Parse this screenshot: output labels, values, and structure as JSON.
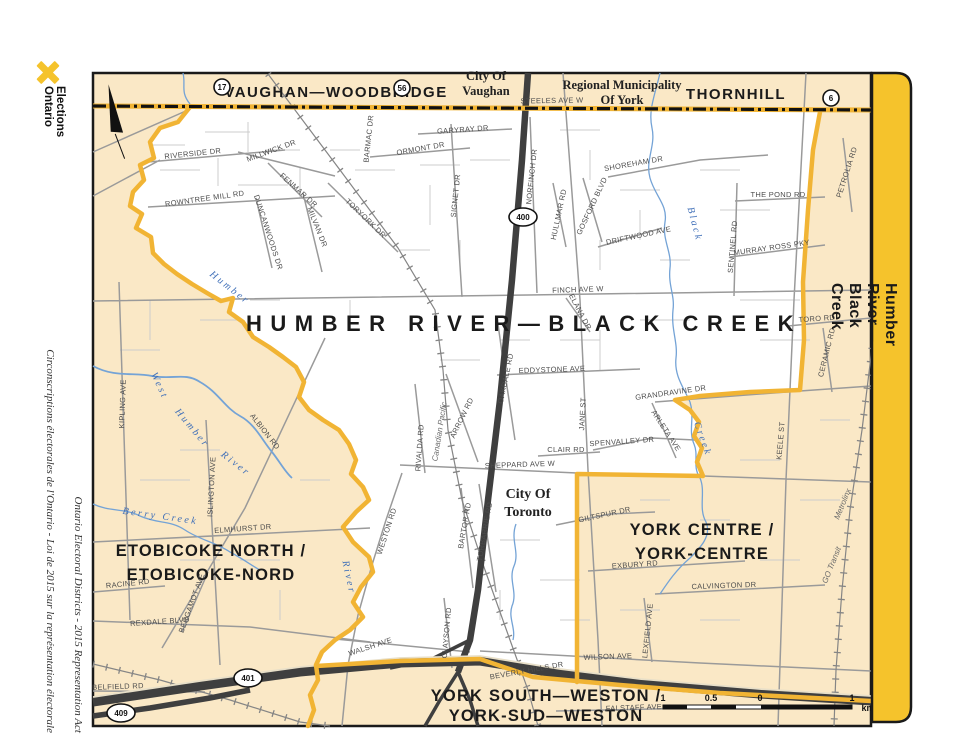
{
  "branding": {
    "logo": "Elections\nOntario"
  },
  "side_captions": {
    "english": "Ontario Electoral Districts - 2015 Representation Act",
    "french": "Circonscriptions électorales de l'Ontario - Loi de 2015 sur la représentation électorale"
  },
  "edge_band": {
    "label": "Humber River—Black Creek"
  },
  "colors": {
    "boundary": "#F1B434",
    "band": "#F5C32C",
    "cream": "#FAE8C6",
    "water": "#74A3D6",
    "highway": "#3f3f3f"
  },
  "map": {
    "title": "HUMBER RIVER—BLACK CREEK",
    "shields": [
      {
        "n": "17",
        "x": 222,
        "y": 87,
        "rx": 8,
        "ry": 8
      },
      {
        "n": "56",
        "x": 402,
        "y": 88,
        "rx": 8,
        "ry": 8
      },
      {
        "n": "6",
        "x": 831,
        "y": 98,
        "rx": 8,
        "ry": 8
      },
      {
        "n": "400",
        "x": 523,
        "y": 217,
        "rx": 14,
        "ry": 9
      },
      {
        "n": "401",
        "x": 248,
        "y": 678,
        "rx": 14,
        "ry": 9
      },
      {
        "n": "409",
        "x": 121,
        "y": 713,
        "rx": 14,
        "ry": 9
      }
    ],
    "scale": {
      "ticks": [
        {
          "t": "1",
          "x": 663
        },
        {
          "t": "0.5",
          "x": 711
        },
        {
          "t": "0",
          "x": 760
        },
        {
          "t": "1",
          "x": 852
        }
      ],
      "unit": "km",
      "unit_x": 868,
      "label_y": 701
    },
    "labels": [
      {
        "t": "HUMBER RIVER—BLACK CREEK",
        "x": 524,
        "y": 331,
        "r": 0,
        "c": "title"
      },
      {
        "t": "VAUGHAN—WOODBRIDGE",
        "x": 336,
        "y": 97,
        "r": 0,
        "c": "band"
      },
      {
        "t": "THORNHILL",
        "x": 736,
        "y": 99,
        "r": 0,
        "c": "band"
      },
      {
        "t": "ETOBICOKE NORTH /",
        "x": 211,
        "y": 556,
        "r": 0,
        "c": "dist"
      },
      {
        "t": "ETOBICOKE-NORD",
        "x": 211,
        "y": 580,
        "r": 0,
        "c": "dist"
      },
      {
        "t": "YORK CENTRE /",
        "x": 702,
        "y": 535,
        "r": 0,
        "c": "dist"
      },
      {
        "t": "YORK-CENTRE",
        "x": 702,
        "y": 559,
        "r": 0,
        "c": "dist"
      },
      {
        "t": "YORK SOUTH—WESTON /",
        "x": 546,
        "y": 701,
        "r": 0,
        "c": "dist"
      },
      {
        "t": "YORK-SUD—WESTON",
        "x": 546,
        "y": 721,
        "r": 0,
        "c": "dist"
      },
      {
        "t": "City Of",
        "x": 486,
        "y": 80,
        "r": 0,
        "c": "muni"
      },
      {
        "t": "Vaughan",
        "x": 486,
        "y": 95,
        "r": 0,
        "c": "muni"
      },
      {
        "t": "Regional Municipality",
        "x": 622,
        "y": 89,
        "r": 0,
        "c": "muni"
      },
      {
        "t": "Of York",
        "x": 622,
        "y": 104,
        "r": 0,
        "c": "muni"
      },
      {
        "t": "City Of",
        "x": 528,
        "y": 498,
        "r": 0,
        "c": "munilg"
      },
      {
        "t": "Toronto",
        "x": 528,
        "y": 516,
        "r": 0,
        "c": "munilg"
      },
      {
        "t": "STEELES AVE W",
        "x": 552,
        "y": 103,
        "r": -1,
        "c": "st"
      },
      {
        "t": "RIVERSIDE DR",
        "x": 193,
        "y": 156,
        "r": -6,
        "c": "st"
      },
      {
        "t": "MILLWICK DR",
        "x": 272,
        "y": 153,
        "r": -20,
        "c": "st"
      },
      {
        "t": "ROWNTREE MILL RD",
        "x": 205,
        "y": 201,
        "r": -8,
        "c": "st"
      },
      {
        "t": "DUNCANWOODS DR",
        "x": 266,
        "y": 233,
        "r": 72,
        "c": "st"
      },
      {
        "t": "MILVAN DR",
        "x": 315,
        "y": 228,
        "r": 68,
        "c": "st"
      },
      {
        "t": "TORYORK DR",
        "x": 364,
        "y": 220,
        "r": 44,
        "c": "st"
      },
      {
        "t": "FENMAR DR",
        "x": 297,
        "y": 192,
        "r": 42,
        "c": "st"
      },
      {
        "t": "BARMAC DR",
        "x": 371,
        "y": 139,
        "r": -84,
        "c": "st"
      },
      {
        "t": "ORMONT DR",
        "x": 421,
        "y": 151,
        "r": -10,
        "c": "st"
      },
      {
        "t": "GARYRAY DR",
        "x": 463,
        "y": 132,
        "r": -4,
        "c": "st"
      },
      {
        "t": "SIGNET DR",
        "x": 458,
        "y": 196,
        "r": -84,
        "c": "st"
      },
      {
        "t": "NORFINCH DR",
        "x": 534,
        "y": 177,
        "r": -84,
        "c": "st"
      },
      {
        "t": "HULLMAR RD",
        "x": 561,
        "y": 215,
        "r": -78,
        "c": "st"
      },
      {
        "t": "GOSFORD BLVD",
        "x": 594,
        "y": 207,
        "r": -65,
        "c": "st"
      },
      {
        "t": "SHOREHAM DR",
        "x": 634,
        "y": 166,
        "r": -10,
        "c": "st"
      },
      {
        "t": "DRIFTWOOD AVE",
        "x": 639,
        "y": 238,
        "r": -12,
        "c": "st"
      },
      {
        "t": "THE POND RD",
        "x": 778,
        "y": 197,
        "r": 0,
        "c": "st"
      },
      {
        "t": "MURRAY ROSS PKY",
        "x": 772,
        "y": 250,
        "r": -8,
        "c": "st"
      },
      {
        "t": "SENTINEL RD",
        "x": 735,
        "y": 247,
        "r": -85,
        "c": "st"
      },
      {
        "t": "PETROLIA RD",
        "x": 849,
        "y": 173,
        "r": -72,
        "c": "st"
      },
      {
        "t": "FINCH AVE W",
        "x": 578,
        "y": 292,
        "r": -2,
        "c": "st"
      },
      {
        "t": "ELANA DR",
        "x": 578,
        "y": 313,
        "r": 62,
        "c": "st"
      },
      {
        "t": "EDDYSTONE AVE",
        "x": 552,
        "y": 372,
        "r": -2,
        "c": "st"
      },
      {
        "t": "OAKDALE RD",
        "x": 508,
        "y": 379,
        "r": -78,
        "c": "st"
      },
      {
        "t": "ARROW RD",
        "x": 464,
        "y": 419,
        "r": -64,
        "c": "st"
      },
      {
        "t": "RIVALDA RD",
        "x": 422,
        "y": 448,
        "r": -86,
        "c": "st"
      },
      {
        "t": "JANE ST",
        "x": 585,
        "y": 414,
        "r": -87,
        "c": "st"
      },
      {
        "t": "SPENVALLEY DR",
        "x": 622,
        "y": 444,
        "r": -4,
        "c": "st"
      },
      {
        "t": "CLAIR RD",
        "x": 566,
        "y": 452,
        "r": 0,
        "c": "st"
      },
      {
        "t": "SHEPPARD AVE W",
        "x": 520,
        "y": 467,
        "r": -2,
        "c": "st"
      },
      {
        "t": "GRANDRAVINE DR",
        "x": 671,
        "y": 395,
        "r": -8,
        "c": "st"
      },
      {
        "t": "ARLETA AVE",
        "x": 664,
        "y": 432,
        "r": 57,
        "c": "st"
      },
      {
        "t": "TORO RD",
        "x": 817,
        "y": 321,
        "r": -4,
        "c": "st"
      },
      {
        "t": "CERAMIC RD",
        "x": 829,
        "y": 353,
        "r": -76,
        "c": "st"
      },
      {
        "t": "KEELE ST",
        "x": 783,
        "y": 441,
        "r": -85,
        "c": "st"
      },
      {
        "t": "GILTSPUR DR",
        "x": 605,
        "y": 517,
        "r": -12,
        "c": "st"
      },
      {
        "t": "EXBURY RD",
        "x": 635,
        "y": 567,
        "r": -4,
        "c": "st"
      },
      {
        "t": "CALVINGTON DR",
        "x": 724,
        "y": 588,
        "r": -2,
        "c": "st"
      },
      {
        "t": "LEXFIELD AVE",
        "x": 650,
        "y": 631,
        "r": -84,
        "c": "st"
      },
      {
        "t": "WILSON AVE",
        "x": 608,
        "y": 659,
        "r": -2,
        "c": "st"
      },
      {
        "t": "BEVERLY HILLS DR",
        "x": 527,
        "y": 673,
        "r": -10,
        "c": "st"
      },
      {
        "t": "WALSH AVE",
        "x": 371,
        "y": 649,
        "r": -18,
        "c": "st"
      },
      {
        "t": "CLAYSON RD",
        "x": 449,
        "y": 633,
        "r": -85,
        "c": "st"
      },
      {
        "t": "BARTOR RD",
        "x": 467,
        "y": 526,
        "r": -80,
        "c": "st"
      },
      {
        "t": "TORBARRIE RD",
        "x": 487,
        "y": 532,
        "r": -80,
        "c": "st"
      },
      {
        "t": "WESTON RD",
        "x": 389,
        "y": 532,
        "r": -72,
        "c": "st"
      },
      {
        "t": "ELMHURST DR",
        "x": 243,
        "y": 531,
        "r": -4,
        "c": "st"
      },
      {
        "t": "ISLINGTON AVE",
        "x": 214,
        "y": 487,
        "r": -87,
        "c": "st"
      },
      {
        "t": "ALBION RD",
        "x": 263,
        "y": 433,
        "r": 52,
        "c": "st"
      },
      {
        "t": "KIPLING AVE",
        "x": 125,
        "y": 404,
        "r": -88,
        "c": "st"
      },
      {
        "t": "RACINE RD",
        "x": 128,
        "y": 586,
        "r": -6,
        "c": "st"
      },
      {
        "t": "BERGAMOT AVE",
        "x": 194,
        "y": 604,
        "r": -70,
        "c": "st"
      },
      {
        "t": "REXDALE BLVD",
        "x": 160,
        "y": 624,
        "r": -4,
        "c": "st"
      },
      {
        "t": "BELFIELD RD",
        "x": 118,
        "y": 689,
        "r": -2,
        "c": "st"
      },
      {
        "t": "FALSTAFF AVE",
        "x": 634,
        "y": 710,
        "r": -2,
        "c": "st"
      },
      {
        "t": "Humber",
        "x": 228,
        "y": 290,
        "r": 38,
        "c": "riv"
      },
      {
        "t": "West",
        "x": 157,
        "y": 387,
        "r": 65,
        "c": "riv"
      },
      {
        "t": "Humber",
        "x": 190,
        "y": 430,
        "r": 50,
        "c": "riv"
      },
      {
        "t": "River",
        "x": 234,
        "y": 466,
        "r": 38,
        "c": "riv"
      },
      {
        "t": "Berry Creek",
        "x": 160,
        "y": 519,
        "r": 8,
        "c": "riv"
      },
      {
        "t": "Black",
        "x": 692,
        "y": 225,
        "r": 75,
        "c": "riv"
      },
      {
        "t": "Creek",
        "x": 700,
        "y": 440,
        "r": 70,
        "c": "riv"
      },
      {
        "t": "River",
        "x": 346,
        "y": 578,
        "r": 78,
        "c": "riv"
      },
      {
        "t": "Canadian Pacific",
        "x": 442,
        "y": 432,
        "r": -81,
        "c": "rail"
      },
      {
        "t": "GO Transit",
        "x": 834,
        "y": 566,
        "r": -68,
        "c": "rail"
      },
      {
        "t": "Metrolinx",
        "x": 845,
        "y": 505,
        "r": -68,
        "c": "rail"
      }
    ]
  }
}
